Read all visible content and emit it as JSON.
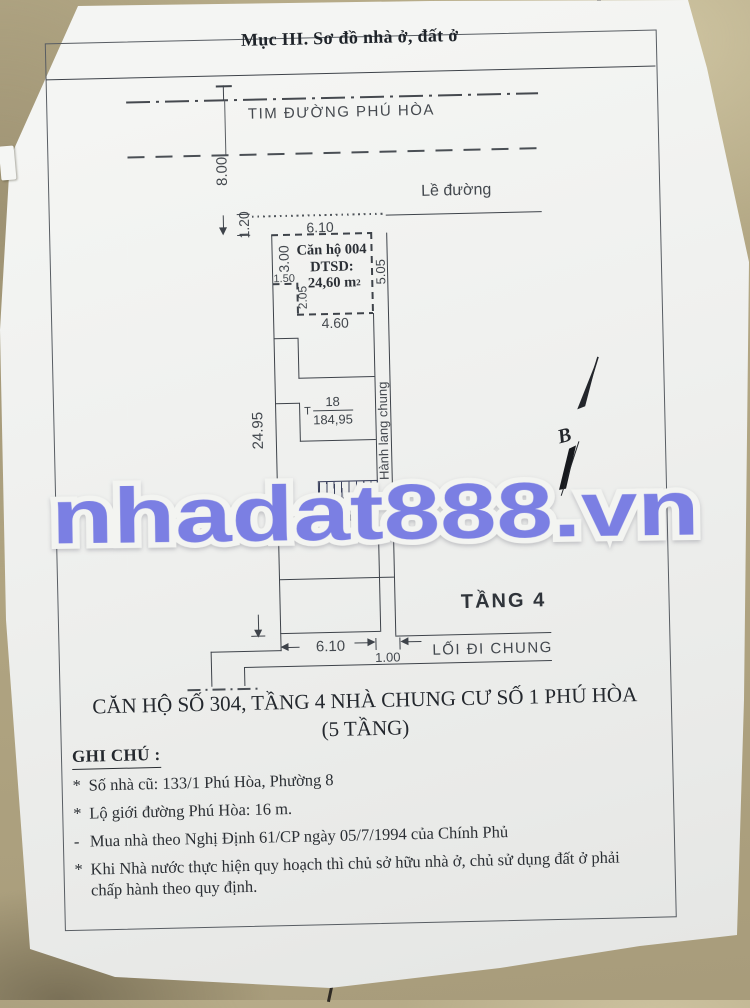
{
  "title": "Mục III. Sơ đồ nhà ở, đất ở",
  "road": {
    "centerline": "TIM ĐƯỜNG PHÚ HÒA",
    "half_width": "8.00",
    "edge_label": "Lề đường"
  },
  "plan": {
    "floor": "TẦNG 4",
    "corridor": "Hành lang chung",
    "walkway": "LỐI ĐI CHUNG",
    "north": "B",
    "unit": {
      "name": "Căn hộ 004",
      "area_label": "DTSD:",
      "area": "24,60 m",
      "area_sup": "2"
    },
    "parcel": {
      "prefix": "T",
      "number": "18",
      "area": "184,95"
    },
    "dims": {
      "sidewalk": "1.20",
      "front": "6.10",
      "d3": "3.00",
      "d15": "1.50",
      "d205": "2.05",
      "d46": "4.60",
      "d505": "5.05",
      "depth": "24.95",
      "front_b": "6.10",
      "walk": "1.00"
    }
  },
  "watermark": "nhadat888.vn",
  "caption": {
    "line1": "CĂN HỘ SỐ 304, TẦNG 4 NHÀ CHUNG CƯ SỐ 1 PHÚ HÒA",
    "line2": "(5 TẦNG)"
  },
  "notes": {
    "heading": "GHI CHÚ :",
    "items": [
      {
        "bullet": "*",
        "text": "Số nhà cũ: 133/1 Phú Hòa, Phường 8"
      },
      {
        "bullet": "*",
        "text": "Lộ giới đường Phú Hòa: 16 m."
      },
      {
        "bullet": "-",
        "text": "Mua nhà theo Nghị Định 61/CP ngày 05/7/1994 của Chính Phủ"
      },
      {
        "bullet": "*",
        "text": "Khi Nhà nước thực hiện quy hoạch thì chủ sở hữu nhà ở, chủ sử dụng đất ở phải chấp hành theo quy định."
      }
    ]
  },
  "colors": {
    "watermark_purple": "#7b7fe3",
    "paper": "#f1f2f0",
    "floor_tan": "#b0a481",
    "ink": "#2e3338",
    "line": "#3e434a"
  }
}
